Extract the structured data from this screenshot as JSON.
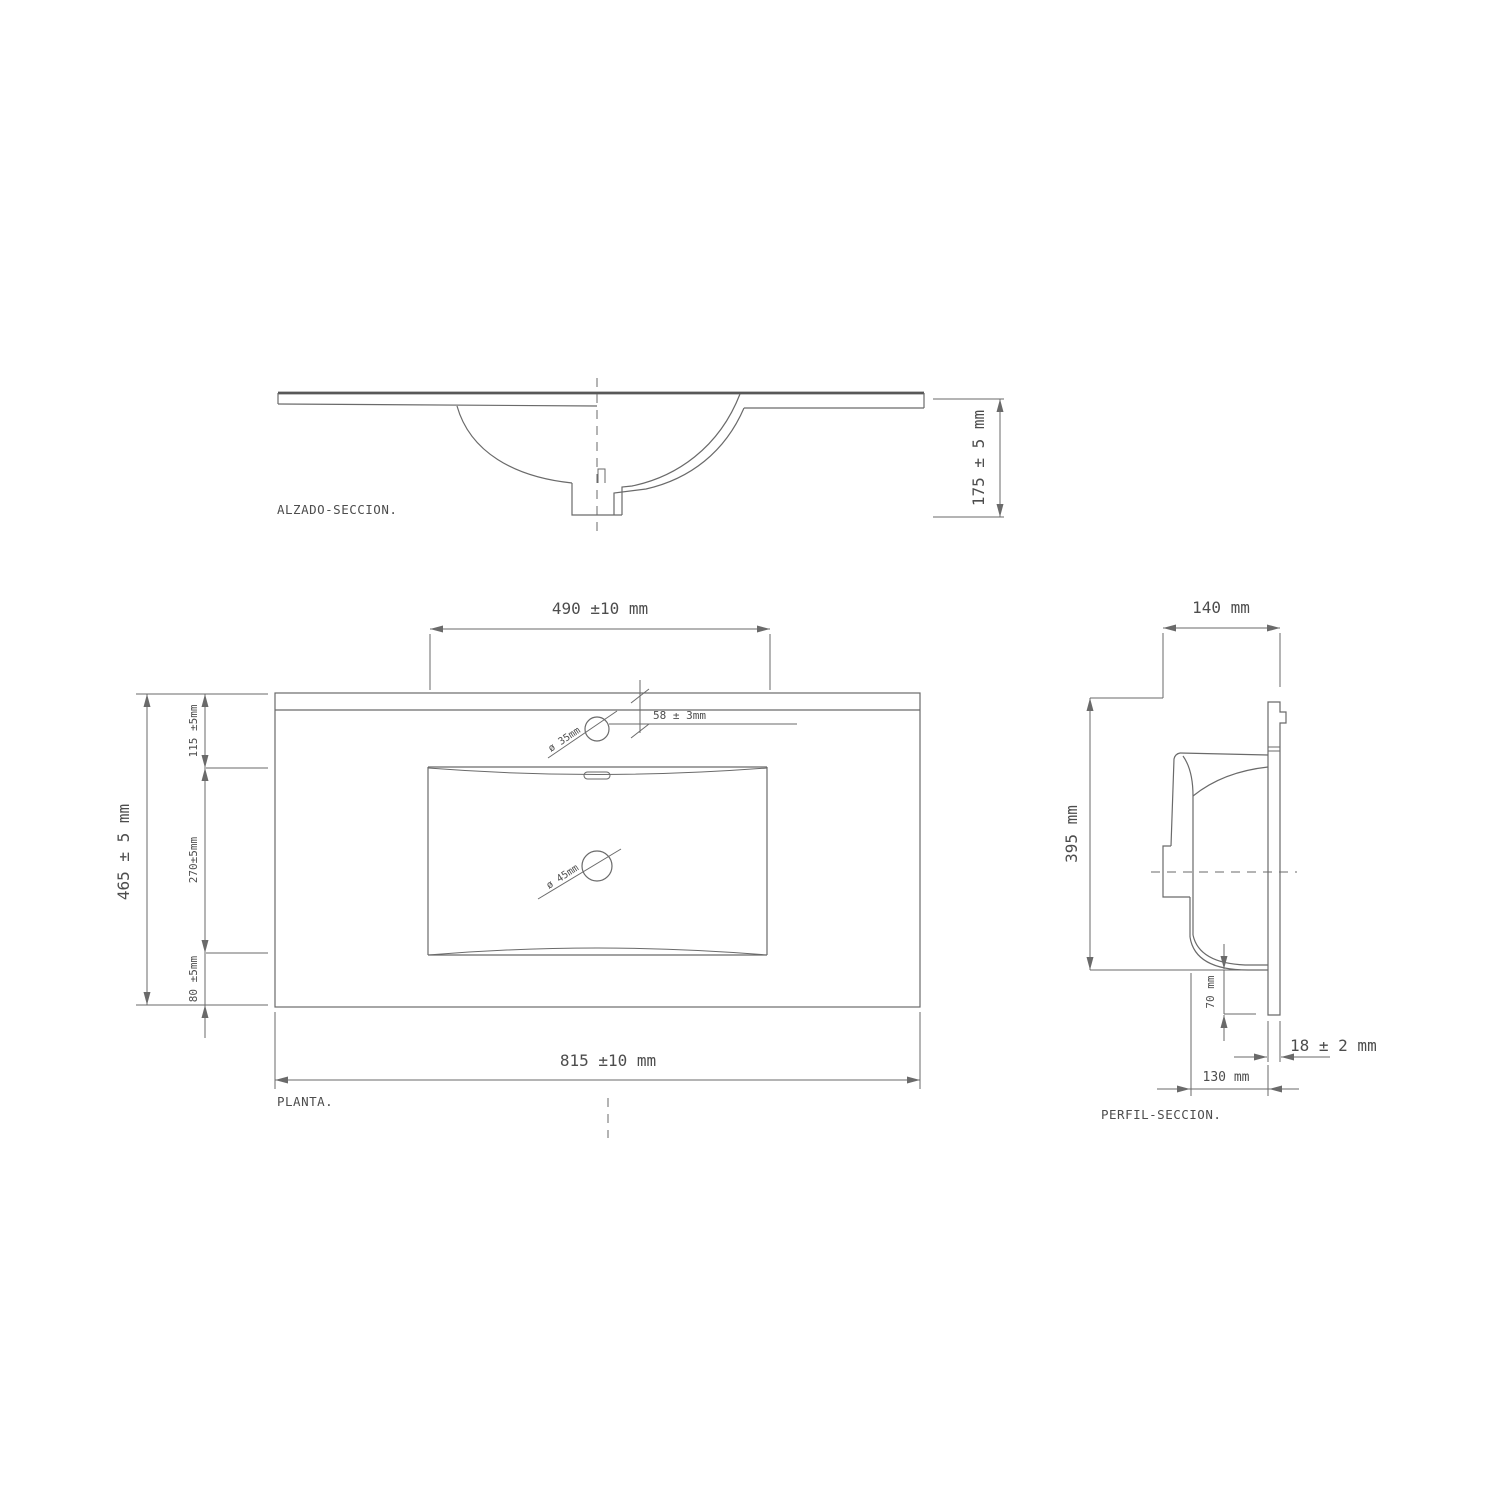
{
  "alzado": {
    "label": "ALZADO-SECCION.",
    "dim_height": "175 ± 5 mm"
  },
  "planta": {
    "label": "PLANTA.",
    "dim_basin_width": "490 ±10 mm",
    "dim_total_width": "815 ±10 mm",
    "dim_total_depth": "465 ± 5 mm",
    "dim_back_depth": "115 ±5mm",
    "dim_basin_depth": "270±5mm",
    "dim_front_depth": "80 ±5mm",
    "dim_faucet_offset": "58 ± 3mm",
    "dim_faucet_hole": "ø 35mm",
    "dim_drain_hole": "ø 45mm"
  },
  "perfil": {
    "label": "PERFIL-SECCION.",
    "dim_top_depth": "140 mm",
    "dim_height": "395 mm",
    "dim_drain_drop": "70 mm",
    "dim_panel_thickness": "18 ± 2 mm",
    "dim_bottom_depth": "130 mm"
  },
  "colors": {
    "line": "#6a6a6a",
    "line_dark": "#585858",
    "text": "#4d4d4d",
    "background": "#ffffff"
  }
}
